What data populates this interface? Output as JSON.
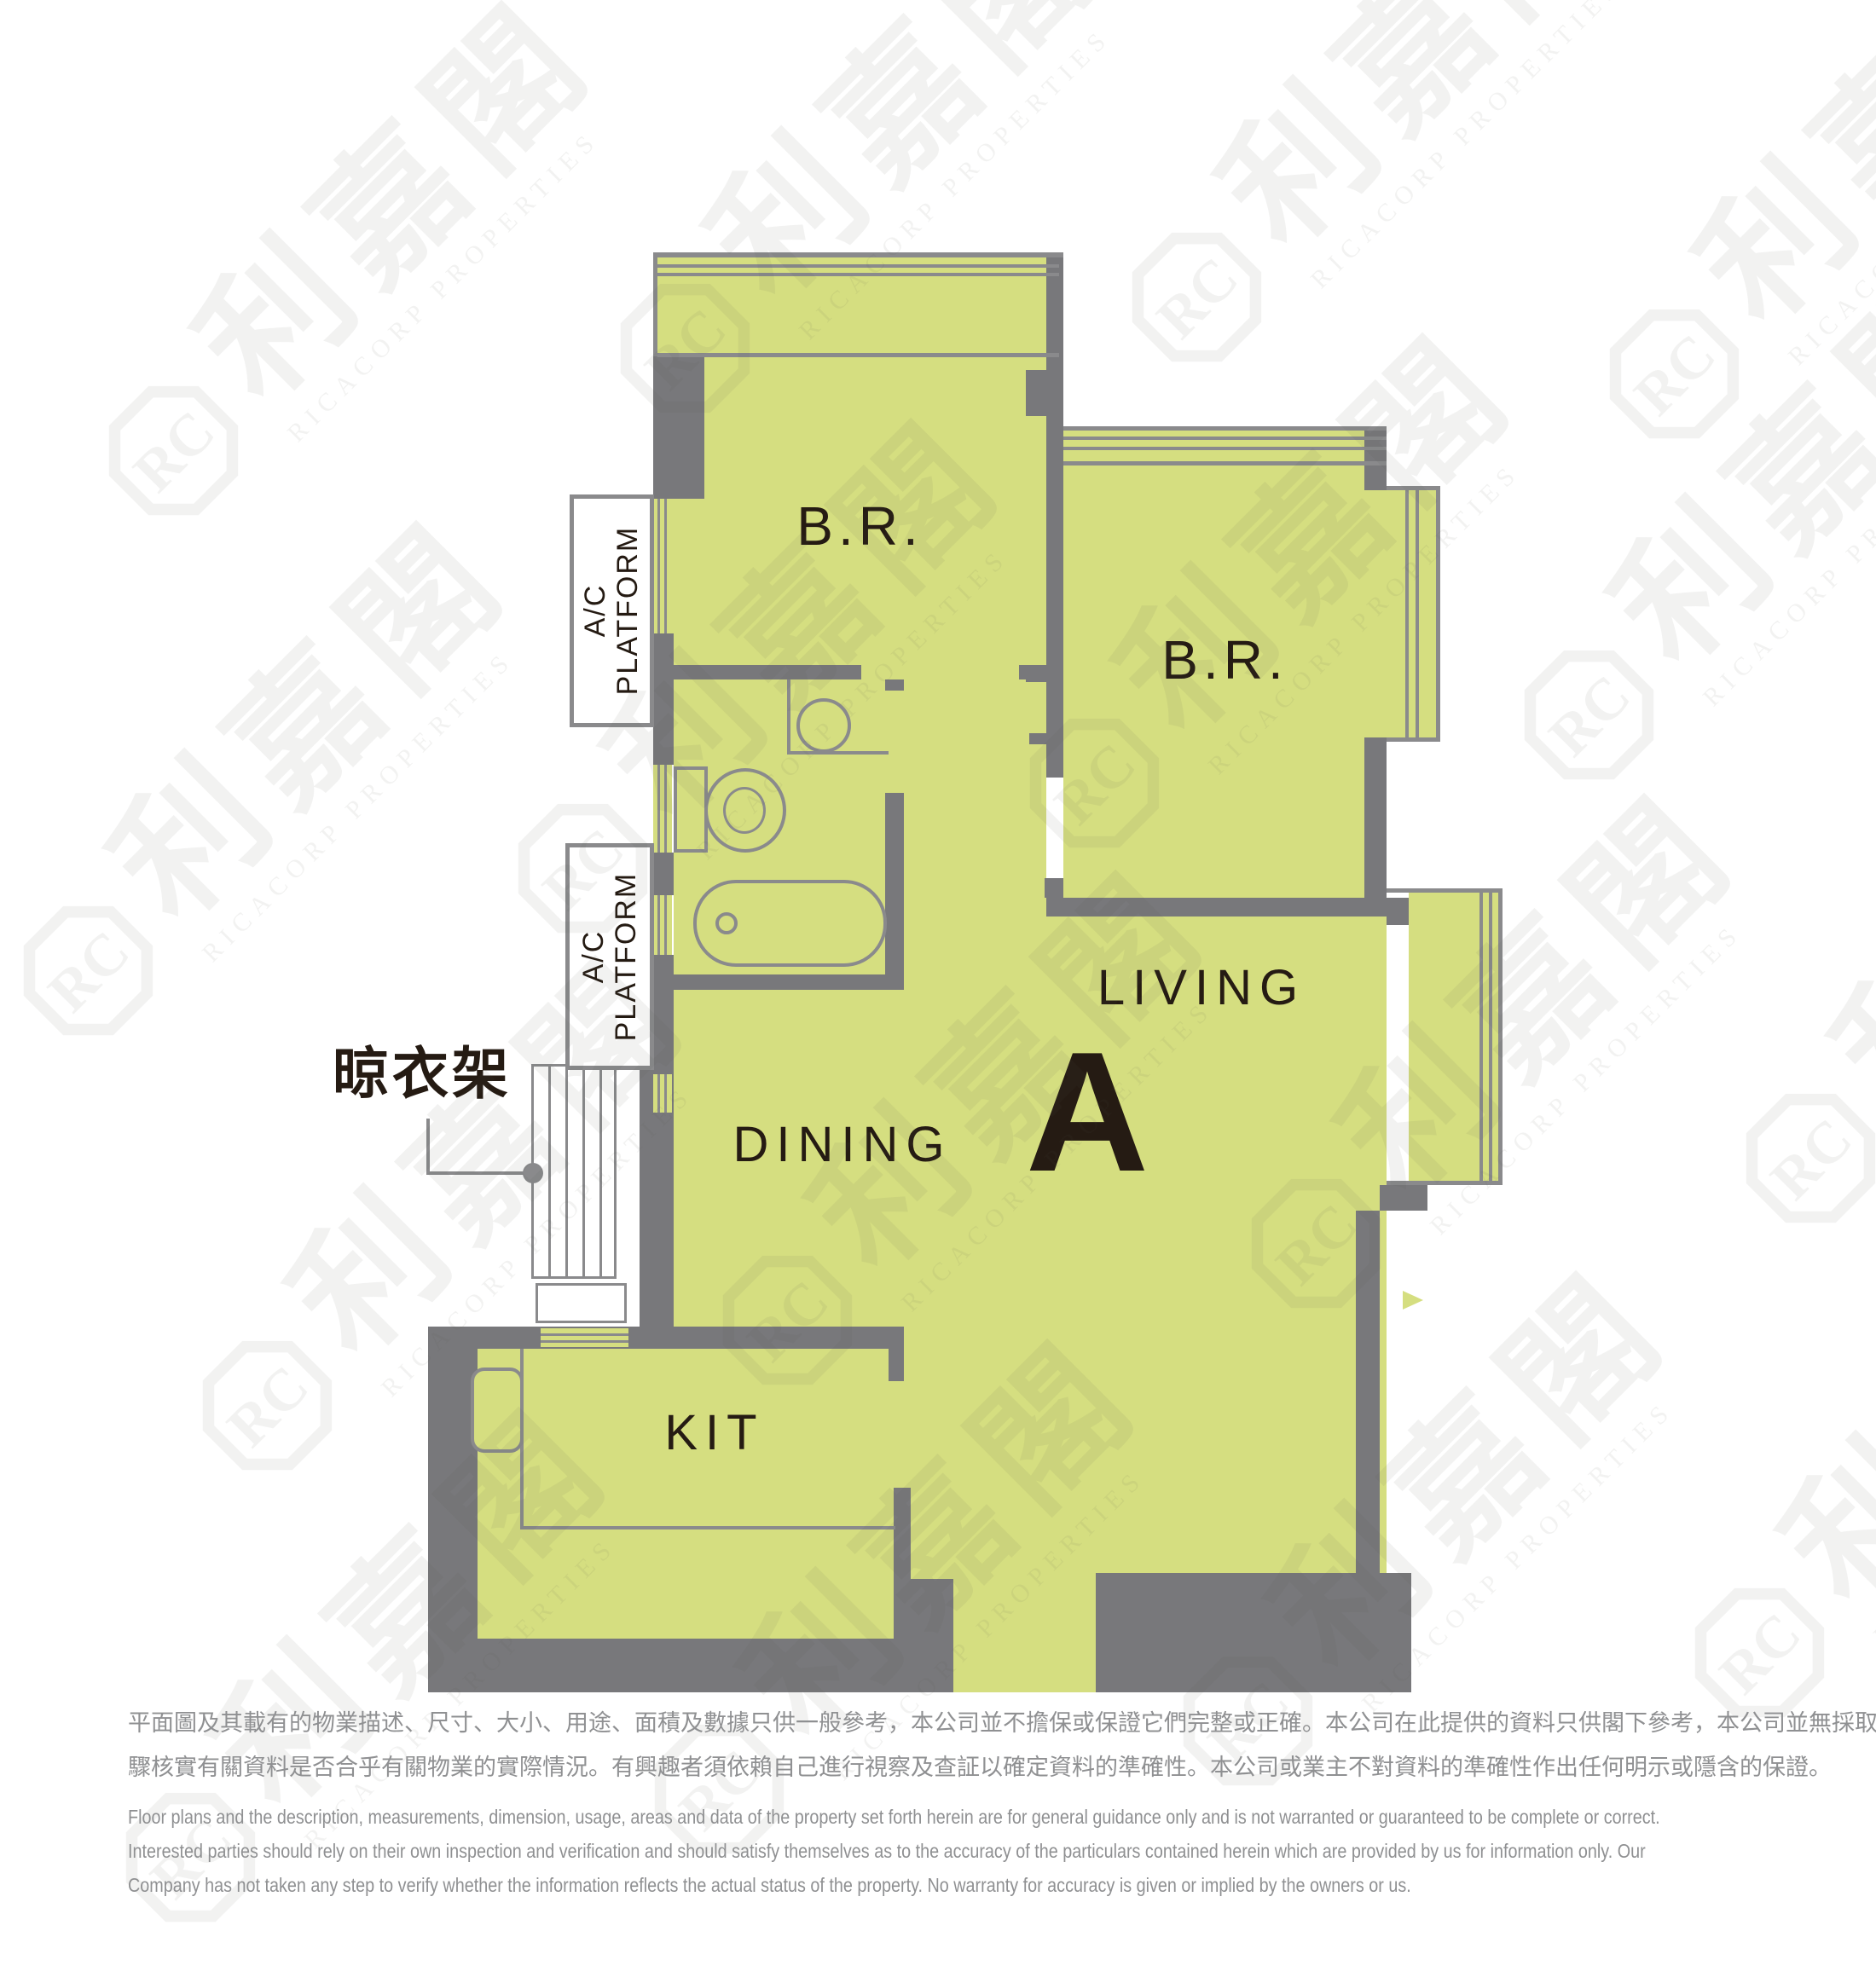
{
  "plan": {
    "unit_letter": "A",
    "labels": {
      "bedroom1": "B.R.",
      "bedroom2": "B.R.",
      "living": "LIVING",
      "dining": "DINING",
      "kitchen": "KIT",
      "ac_platform_top": "A/C\nPLATFORM",
      "ac_platform_bottom": "A/C\nPLATFORM",
      "drying_rack": "晾衣架"
    }
  },
  "watermark": {
    "logo": "RC",
    "cn": "利嘉閣",
    "en": "RICACORP PROPERTIES"
  },
  "disclaimer": {
    "cn_line1": "平面圖及其載有的物業描述、尺寸、大小、用途、面積及數據只供一般參考，本公司並不擔保或保證它們完整或正確。本公司在此提供的資料只供閣下參考，本公司並無採取任何步",
    "cn_line2": "驟核實有關資料是否合乎有關物業的實際情況。有興趣者須依賴自己進行視察及查証以確定資料的準確性。本公司或業主不對資料的準確性作出任何明示或隱含的保證。",
    "en_line1": "Floor plans and the description, measurements, dimension, usage, areas and data of the property set forth herein are for general guidance only and is not warranted or guaranteed to be complete or correct.",
    "en_line2": "Interested parties should rely on their own inspection and verification and should satisfy themselves as to the accuracy of the particulars contained herein which are provided by us for information only.  Our",
    "en_line3": "Company has not taken any step to verify whether the information reflects the actual status of the property.  No warranty for accuracy is given or implied by the owners or us."
  },
  "colors": {
    "room_fill": "#d5de80",
    "wall": "#78787b",
    "thin_line": "#8a8a8c",
    "label_text": "#251b13",
    "disclaimer_text": "#8f9092"
  }
}
